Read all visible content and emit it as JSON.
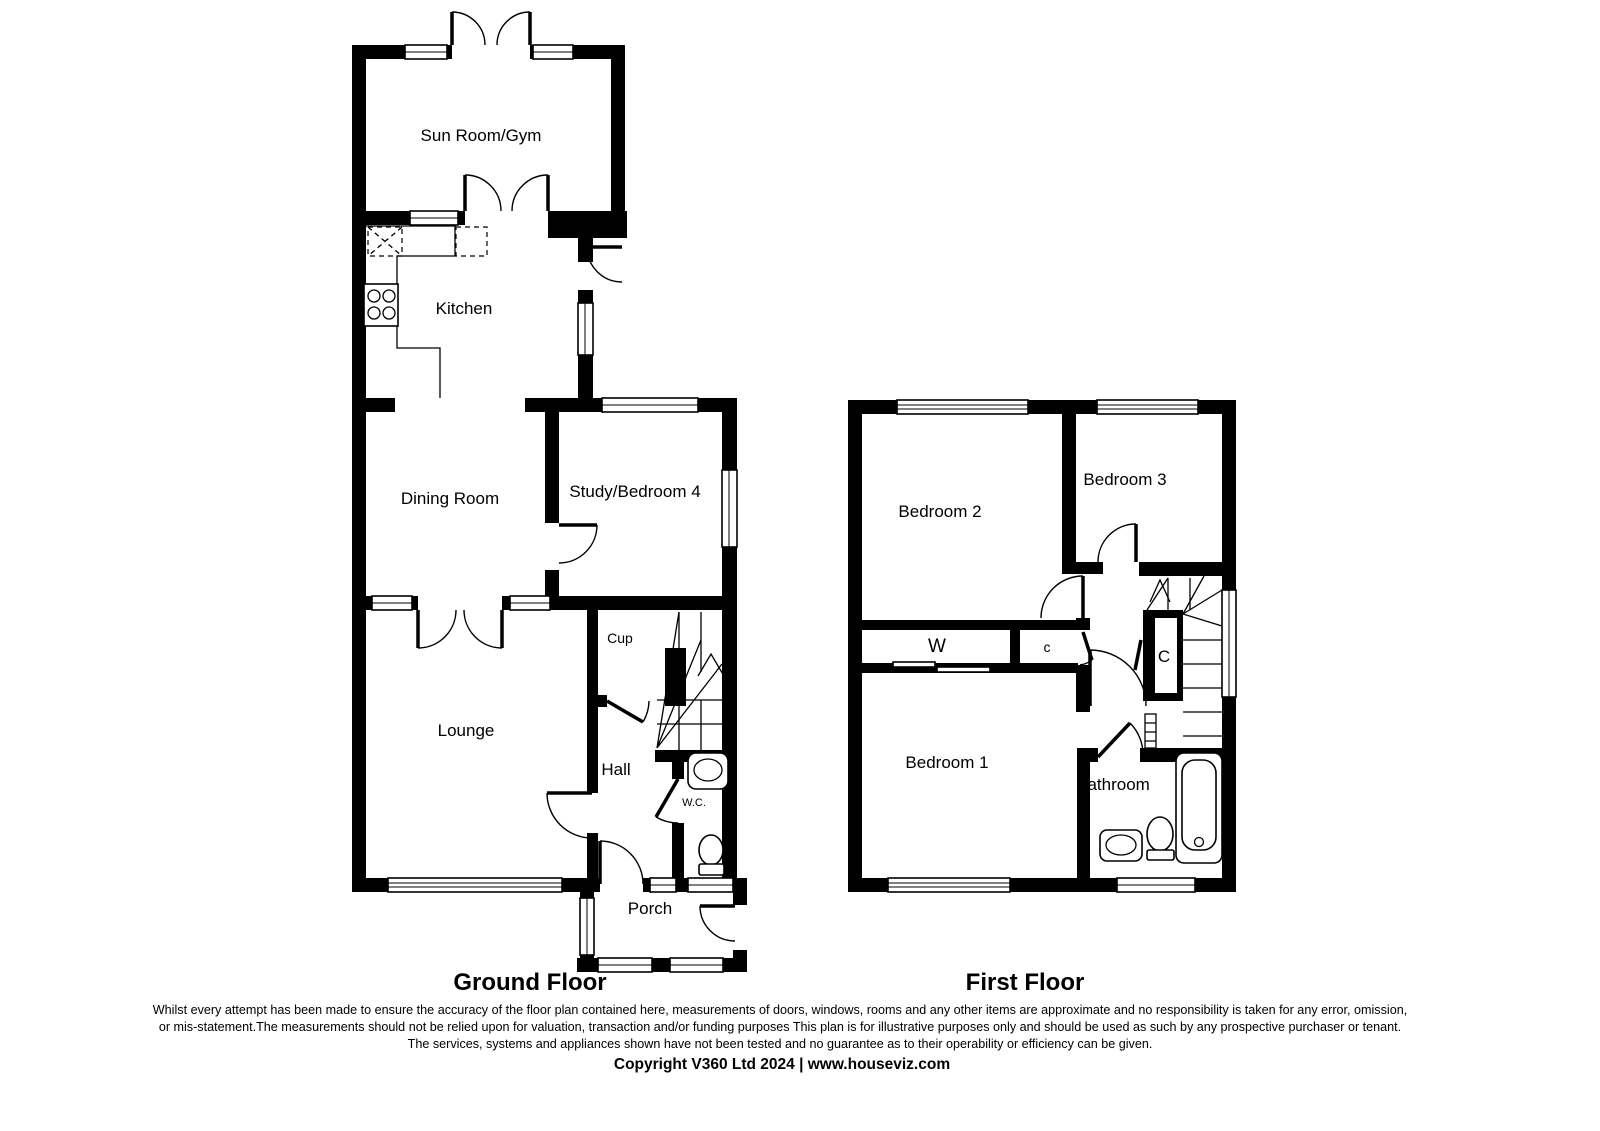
{
  "ground_floor": {
    "title": "Ground Floor",
    "rooms": {
      "sun_room": "Sun Room/Gym",
      "kitchen": "Kitchen",
      "dining": "Dining Room",
      "study": "Study/Bedroom 4",
      "cup": "Cup",
      "lounge": "Lounge",
      "hall": "Hall",
      "wc": "W.C.",
      "porch": "Porch"
    }
  },
  "first_floor": {
    "title": "First Floor",
    "rooms": {
      "bedroom2": "Bedroom 2",
      "bedroom3": "Bedroom 3",
      "bedroom1": "Bedroom 1",
      "bathroom": "Bathroom",
      "wardrobe": "W",
      "closet_small": "c",
      "closet_large": "C"
    }
  },
  "footer": {
    "disclaimer_line1": "Whilst every attempt has been made to ensure the accuracy of the floor plan contained here, measurements of doors, windows, rooms and any other items are approximate and no responsibility is taken for any error, omission,",
    "disclaimer_line2": "or mis-statement.The measurements should not be relied upon for valuation, transaction and/or funding purposes This plan is for illustrative purposes only and should be used as such by any prospective purchaser or tenant.",
    "disclaimer_line3": "The services, systems and appliances shown have not been tested and no guarantee as to their operability or efficiency can be given.",
    "copyright": "Copyright V360 Ltd 2024 | www.houseviz.com"
  },
  "colors": {
    "wall": "#000000",
    "background": "#ffffff"
  }
}
